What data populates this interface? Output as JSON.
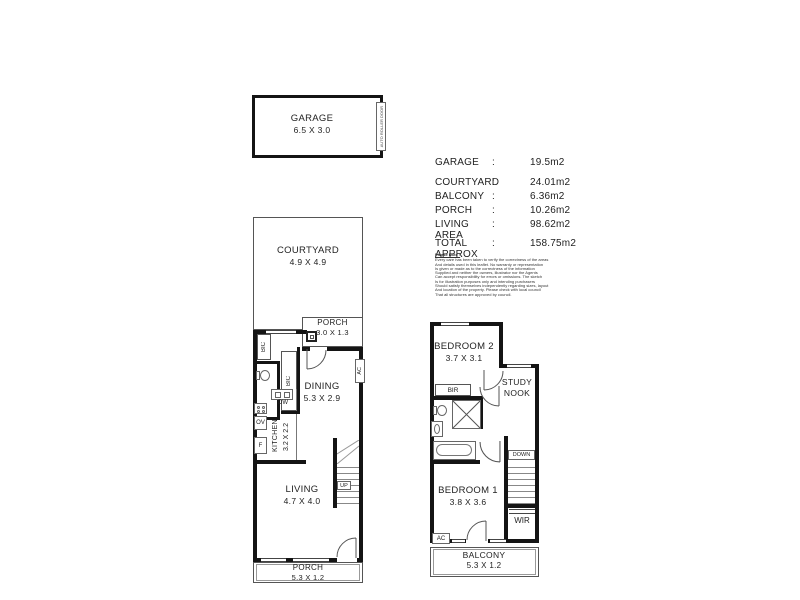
{
  "garage": {
    "label": "GARAGE",
    "dims": "6.5 X 3.0",
    "door": "AUTO ROLLER DOOR"
  },
  "ground": {
    "courtyard_label": "COURTYARD",
    "courtyard_dims": "4.9 X 4.9",
    "porch_top_label": "PORCH",
    "porch_top_dims": "3.0 X 1.3",
    "dining_label": "DINING",
    "dining_dims": "5.3 X 2.9",
    "kitchen_label": "KITCHEN",
    "kitchen_dims": "3.2 X 2.2",
    "living_label": "LIVING",
    "living_dims": "4.7 X 4.0",
    "porch_bottom_label": "PORCH",
    "porch_bottom_dims": "5.3 X 1.2",
    "bic1": "BIC",
    "bic2": "BIC",
    "ac": "AC",
    "dw": "DW",
    "ov": "OV",
    "fridge": "F",
    "up": "UP"
  },
  "upper": {
    "bedroom2_label": "BEDROOM 2",
    "bedroom2_dims": "3.7 X 3.1",
    "study1": "STUDY",
    "study2": "NOOK",
    "bir": "BIR",
    "down": "DOWN",
    "wir": "WIR",
    "ac": "AC",
    "bedroom1_label": "BEDROOM 1",
    "bedroom1_dims": "3.8 X 3.6",
    "balcony_label": "BALCONY",
    "balcony_dims": "5.3 X 1.2"
  },
  "areas": {
    "rows": [
      {
        "label": "GARAGE",
        "colon": ":",
        "value": "19.5m2"
      },
      {
        "label": "COURTYARD",
        "colon": ":",
        "value": "24.01m2"
      },
      {
        "label": "BALCONY",
        "colon": ":",
        "value": "6.36m2"
      },
      {
        "label": "PORCH",
        "colon": ":",
        "value": "10.26m2"
      },
      {
        "label": "LIVING AREA",
        "colon": ":",
        "value": "98.62m2"
      }
    ],
    "total_label": "TOTAL APPROX",
    "total_colon": ":",
    "total_value": "158.75m2"
  },
  "disclaimer": {
    "title": "Please Note :",
    "lines": [
      "Every care has been taken to verify the correctness of the areas",
      "And details used in this leaflet. No warranty or representation",
      "Is given or made as to the correctness of the information",
      "Supplied and neither the owners, illustrator nor the Agents",
      "Can accept responsibility for errors or omissions. The sketch",
      "Is for illustration purposes only and intending purchasers",
      "Should satisfy themselves independently regarding sizes, layout",
      "And location of the property. Please check with local council",
      "That all structures are approved by council."
    ]
  }
}
